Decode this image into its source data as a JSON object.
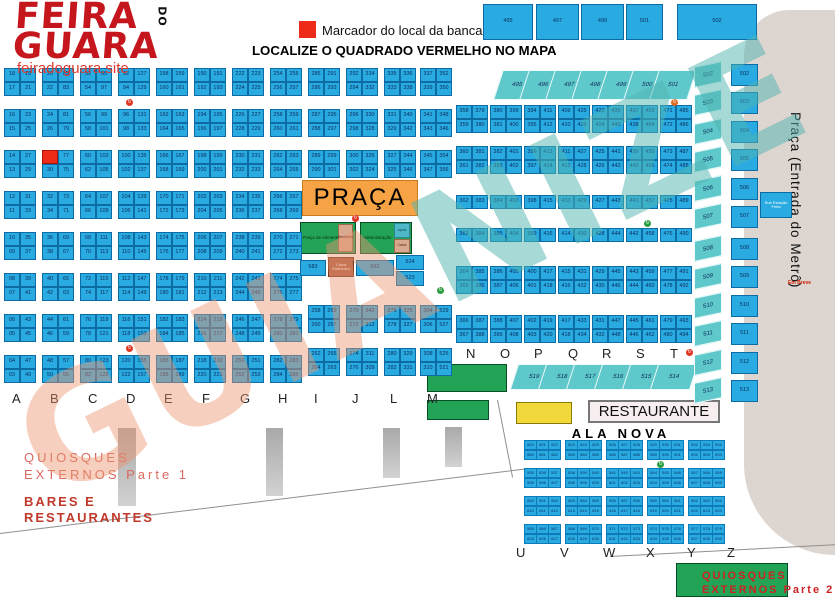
{
  "logo": {
    "line1": "FEIRA",
    "line2": "GUARA",
    "do_text": "DO",
    "site": "feiradoguara.site"
  },
  "legend": {
    "marker_label": "Marcador do local da banca"
  },
  "title": "LOCALIZE O QUADRADO VERMELHO NO MAPA",
  "watermark": "GUIANIZE",
  "metro": {
    "label": "Praça (Entrada do Metrô)",
    "em_breve": "Em Breve",
    "sub_estacao": "Sub Estação Feira"
  },
  "praca": {
    "title": "PRAÇA",
    "food_label": "Praça de Alimentação",
    "wc_label": "Banheiros",
    "admin_label": "Administração",
    "apoio_label": "Apoio",
    "caixa_interna_label": "Caixa",
    "caixa_eletronico_label": "Caixa Eletrônico",
    "single_cells": [
      "583",
      "562",
      "524",
      "523"
    ]
  },
  "restaurante_label": "RESTAURANTE",
  "ala_nova_title": "ALA NOVA",
  "quiosques1": {
    "line1": "QUIOSQUES",
    "line2": "EXTERNOS Parte 1"
  },
  "bares": {
    "line1": "BARES E",
    "line2": "RESTAURANTES"
  },
  "quiosques2": {
    "line1": "QUIOSQUES",
    "line2": "EXTERNOS Parte 2"
  },
  "top_row": [
    "495",
    "497",
    "499",
    "501",
    "502"
  ],
  "diag_row_top": [
    "495",
    "496",
    "497",
    "498",
    "499",
    "500",
    "501"
  ],
  "teal_column": [
    "502",
    "503",
    "504",
    "505",
    "506",
    "507",
    "508",
    "509",
    "510",
    "511",
    "512",
    "513"
  ],
  "blue_column": [
    "502",
    "503",
    "504",
    "505",
    "506",
    "507",
    "508",
    "509",
    "510",
    "511",
    "512",
    "513"
  ],
  "diag_row_bottom": [
    "519",
    "518",
    "517",
    "516",
    "515",
    "514"
  ],
  "left_letters": [
    "A",
    "B",
    "C",
    "D",
    "E",
    "F",
    "G",
    "H",
    "I",
    "J",
    "L",
    "M"
  ],
  "right_letters": [
    "N",
    "O",
    "P",
    "Q",
    "R",
    "S",
    "T"
  ],
  "ala_letters": [
    "U",
    "V",
    "W",
    "X",
    "Y",
    "Z"
  ],
  "grid": {
    "full_columns": [
      {
        "letter": "A",
        "x": 4,
        "red_index": -1,
        "left": [
          "18",
          "17",
          "16",
          "15",
          "14",
          "13",
          "12",
          "11",
          "10",
          "09",
          "08",
          "07",
          "06",
          "05",
          "04",
          "03"
        ],
        "right": [
          "19",
          "21",
          "23",
          "25",
          "27",
          "29",
          "31",
          "33",
          "35",
          "37",
          "39",
          "41",
          "43",
          "45",
          "47",
          "49"
        ]
      },
      {
        "letter": "B",
        "x": 42,
        "red_index": 4,
        "left": [
          "20",
          "22",
          "24",
          "26",
          "28",
          "30",
          "32",
          "34",
          "36",
          "38",
          "40",
          "42",
          "44",
          "46",
          "48",
          "50"
        ],
        "right": [
          "85",
          "83",
          "81",
          "79",
          "77",
          "75",
          "73",
          "71",
          "69",
          "67",
          "65",
          "63",
          "61",
          "59",
          "57",
          "55"
        ]
      },
      {
        "letter": "C",
        "x": 80,
        "red_index": -1,
        "left": [
          "52",
          "54",
          "56",
          "58",
          "60",
          "62",
          "64",
          "66",
          "68",
          "70",
          "72",
          "74",
          "76",
          "78",
          "80",
          "82"
        ],
        "right": [
          "95",
          "97",
          "99",
          "101",
          "103",
          "105",
          "107",
          "109",
          "111",
          "113",
          "115",
          "117",
          "119",
          "121",
          "123",
          "125"
        ]
      },
      {
        "letter": "D",
        "x": 118,
        "red_index": -1,
        "left": [
          "92",
          "94",
          "96",
          "98",
          "100",
          "102",
          "104",
          "106",
          "108",
          "110",
          "112",
          "114",
          "116",
          "118",
          "120",
          "122"
        ],
        "right": [
          "127",
          "129",
          "131",
          "133",
          "135",
          "137",
          "139",
          "141",
          "143",
          "145",
          "147",
          "149",
          "151",
          "153",
          "155",
          "157"
        ]
      },
      {
        "letter": "E",
        "x": 156,
        "red_index": -1,
        "left": [
          "158",
          "160",
          "162",
          "164",
          "166",
          "168",
          "170",
          "172",
          "174",
          "176",
          "178",
          "180",
          "182",
          "184",
          "186",
          "188"
        ],
        "right": [
          "159",
          "161",
          "163",
          "165",
          "167",
          "169",
          "171",
          "173",
          "175",
          "177",
          "179",
          "181",
          "183",
          "185",
          "187",
          "189"
        ]
      },
      {
        "letter": "F",
        "x": 194,
        "red_index": -1,
        "left": [
          "190",
          "192",
          "194",
          "196",
          "198",
          "200",
          "202",
          "204",
          "206",
          "208",
          "210",
          "212",
          "214",
          "216",
          "218",
          "220"
        ],
        "right": [
          "191",
          "193",
          "195",
          "197",
          "199",
          "201",
          "203",
          "205",
          "207",
          "209",
          "211",
          "213",
          "215",
          "217",
          "219",
          "221"
        ]
      },
      {
        "letter": "G",
        "x": 232,
        "red_index": -1,
        "left": [
          "222",
          "224",
          "226",
          "228",
          "230",
          "232",
          "234",
          "236",
          "238",
          "240",
          "242",
          "244",
          "246",
          "248",
          "250",
          "252"
        ],
        "right": [
          "223",
          "225",
          "227",
          "229",
          "231",
          "233",
          "235",
          "237",
          "239",
          "241",
          "243",
          "245",
          "247",
          "249",
          "251",
          "253"
        ]
      },
      {
        "letter": "H",
        "x": 270,
        "red_index": -1,
        "left": [
          "254",
          "256",
          "258",
          "260",
          "262",
          "264",
          "266",
          "268",
          "270",
          "272",
          "274",
          "276",
          "278",
          "280",
          "282",
          "284"
        ],
        "right": [
          "255",
          "257",
          "259",
          "261",
          "263",
          "265",
          "267",
          "269",
          "271",
          "273",
          "275",
          "277",
          "279",
          "281",
          "283",
          "285"
        ]
      }
    ],
    "partial_columns": [
      {
        "letter": "I",
        "x": 308,
        "top": [
          [
            "285",
            "291"
          ],
          [
            "286",
            "293"
          ],
          [
            "287",
            "295"
          ],
          [
            "288",
            "297"
          ],
          [
            "289",
            "299"
          ],
          [
            "290",
            "301"
          ]
        ],
        "bottom": [
          [
            "258",
            "269"
          ],
          [
            "260",
            "267"
          ],
          [
            "262",
            "265"
          ],
          [
            "264",
            "263"
          ]
        ]
      },
      {
        "letter": "J",
        "x": 346,
        "top": [
          [
            "292",
            "334"
          ],
          [
            "294",
            "332"
          ],
          [
            "296",
            "330"
          ],
          [
            "298",
            "328"
          ],
          [
            "300",
            "326"
          ],
          [
            "302",
            "324"
          ]
        ],
        "bottom": [
          [
            "270",
            "342"
          ],
          [
            "272",
            "313"
          ],
          [
            "274",
            "311"
          ],
          [
            "276",
            "309"
          ]
        ]
      },
      {
        "letter": "L",
        "x": 384,
        "top": [
          [
            "335",
            "336"
          ],
          [
            "333",
            "338"
          ],
          [
            "331",
            "340"
          ],
          [
            "329",
            "342"
          ],
          [
            "327",
            "344"
          ],
          [
            "325",
            "346"
          ]
        ],
        "bottom": [
          [
            "276",
            "325"
          ],
          [
            "278",
            "327"
          ],
          [
            "280",
            "329"
          ],
          [
            "282",
            "331"
          ]
        ]
      },
      {
        "letter": "M",
        "x": 420,
        "top": [
          [
            "337",
            "352"
          ],
          [
            "339",
            "350"
          ],
          [
            "341",
            "348"
          ],
          [
            "343",
            "346"
          ],
          [
            "345",
            "354"
          ],
          [
            "347",
            "356"
          ]
        ],
        "bottom": [
          [
            "304",
            "529"
          ],
          [
            "306",
            "527"
          ],
          [
            "308",
            "525"
          ],
          [
            "310",
            "521"
          ]
        ]
      }
    ],
    "right_pairs": [
      {
        "x": 456,
        "rows": [
          [
            "358",
            "379"
          ],
          [
            "359",
            "380"
          ],
          [
            "360",
            "381"
          ],
          [
            "361",
            "382"
          ],
          [
            "362",
            "383"
          ],
          [
            "363",
            "384"
          ],
          [
            "364",
            "385"
          ],
          [
            "365",
            "386"
          ],
          [
            "366",
            "387"
          ],
          [
            "367",
            "388"
          ]
        ]
      },
      {
        "x": 490,
        "rows": [
          [
            "380",
            "399"
          ],
          [
            "381",
            "400"
          ],
          [
            "382",
            "401"
          ],
          [
            "383",
            "402"
          ],
          [
            "384",
            "403"
          ],
          [
            "385",
            "404"
          ],
          [
            "386",
            "405"
          ],
          [
            "387",
            "406"
          ],
          [
            "388",
            "407"
          ],
          [
            "389",
            "408"
          ]
        ]
      },
      {
        "x": 524,
        "rows": [
          [
            "394",
            "411"
          ],
          [
            "395",
            "412"
          ],
          [
            "396",
            "413"
          ],
          [
            "397",
            "414"
          ],
          [
            "398",
            "415"
          ],
          [
            "399",
            "416"
          ],
          [
            "400",
            "417"
          ],
          [
            "401",
            "418"
          ],
          [
            "402",
            "419"
          ],
          [
            "403",
            "420"
          ]
        ]
      },
      {
        "x": 558,
        "rows": [
          [
            "409",
            "425"
          ],
          [
            "410",
            "426"
          ],
          [
            "411",
            "427"
          ],
          [
            "412",
            "428"
          ],
          [
            "413",
            "429"
          ],
          [
            "414",
            "430"
          ],
          [
            "415",
            "431"
          ],
          [
            "416",
            "432"
          ],
          [
            "417",
            "433"
          ],
          [
            "418",
            "434"
          ]
        ]
      },
      {
        "x": 592,
        "rows": [
          [
            "423",
            "439"
          ],
          [
            "424",
            "440"
          ],
          [
            "425",
            "441"
          ],
          [
            "426",
            "442"
          ],
          [
            "427",
            "443"
          ],
          [
            "428",
            "444"
          ],
          [
            "429",
            "445"
          ],
          [
            "430",
            "446"
          ],
          [
            "431",
            "447"
          ],
          [
            "432",
            "448"
          ]
        ]
      },
      {
        "x": 626,
        "rows": [
          [
            "437",
            "453"
          ],
          [
            "438",
            "454"
          ],
          [
            "439",
            "455"
          ],
          [
            "440",
            "456"
          ],
          [
            "441",
            "457"
          ],
          [
            "442",
            "458"
          ],
          [
            "443",
            "459"
          ],
          [
            "444",
            "460"
          ],
          [
            "445",
            "461"
          ],
          [
            "446",
            "462"
          ]
        ]
      },
      {
        "x": 660,
        "rows": [
          [
            "471",
            "485"
          ],
          [
            "472",
            "486"
          ],
          [
            "473",
            "487"
          ],
          [
            "474",
            "488"
          ],
          [
            "475",
            "489"
          ],
          [
            "476",
            "490"
          ],
          [
            "477",
            "491"
          ],
          [
            "478",
            "492"
          ],
          [
            "479",
            "493"
          ],
          [
            "480",
            "494"
          ]
        ]
      }
    ]
  },
  "ala_nova_blocks": [
    {
      "top": [
        "520",
        "521",
        "522"
      ],
      "bottom": [
        "580",
        "581",
        "582"
      ]
    },
    {
      "top": [
        "523",
        "524",
        "525"
      ],
      "bottom": [
        "583",
        "584",
        "585"
      ]
    },
    {
      "top": [
        "526",
        "527",
        "528"
      ],
      "bottom": [
        "586",
        "587",
        "588"
      ]
    },
    {
      "top": [
        "529",
        "530",
        "531"
      ],
      "bottom": [
        "589",
        "590",
        "591"
      ]
    },
    {
      "top": [
        "532",
        "533",
        "534"
      ],
      "bottom": [
        "592",
        "593",
        "594"
      ]
    },
    {
      "top": [
        "535",
        "536",
        "537"
      ],
      "bottom": [
        "595",
        "596",
        "597"
      ]
    },
    {
      "top": [
        "538",
        "539",
        "540"
      ],
      "bottom": [
        "598",
        "599",
        "600"
      ]
    },
    {
      "top": [
        "541",
        "542",
        "543"
      ],
      "bottom": [
        "601",
        "602",
        "603"
      ]
    },
    {
      "top": [
        "544",
        "545",
        "546"
      ],
      "bottom": [
        "604",
        "605",
        "606"
      ]
    },
    {
      "top": [
        "547",
        "548",
        "549"
      ],
      "bottom": [
        "607",
        "608",
        "609"
      ]
    },
    {
      "top": [
        "550",
        "551",
        "552"
      ],
      "bottom": [
        "610",
        "611",
        "612"
      ]
    },
    {
      "top": [
        "553",
        "554",
        "555"
      ],
      "bottom": [
        "613",
        "614",
        "615"
      ]
    },
    {
      "top": [
        "556",
        "557",
        "558"
      ],
      "bottom": [
        "616",
        "617",
        "618"
      ]
    },
    {
      "top": [
        "559",
        "560",
        "561"
      ],
      "bottom": [
        "619",
        "620",
        "621"
      ]
    },
    {
      "top": [
        "562",
        "563",
        "564"
      ],
      "bottom": [
        "622",
        "623",
        "624"
      ]
    },
    {
      "top": [
        "565",
        "566",
        "567"
      ],
      "bottom": [
        "625",
        "626",
        "627"
      ]
    },
    {
      "top": [
        "568",
        "569",
        "570"
      ],
      "bottom": [
        "628",
        "629",
        "630"
      ]
    },
    {
      "top": [
        "571",
        "572",
        "573"
      ],
      "bottom": [
        "631",
        "632",
        "633"
      ]
    },
    {
      "top": [
        "574",
        "575",
        "576"
      ],
      "bottom": [
        "634",
        "635",
        "636"
      ]
    },
    {
      "top": [
        "577",
        "578",
        "579"
      ],
      "bottom": [
        "637",
        "638",
        "639"
      ]
    }
  ]
}
